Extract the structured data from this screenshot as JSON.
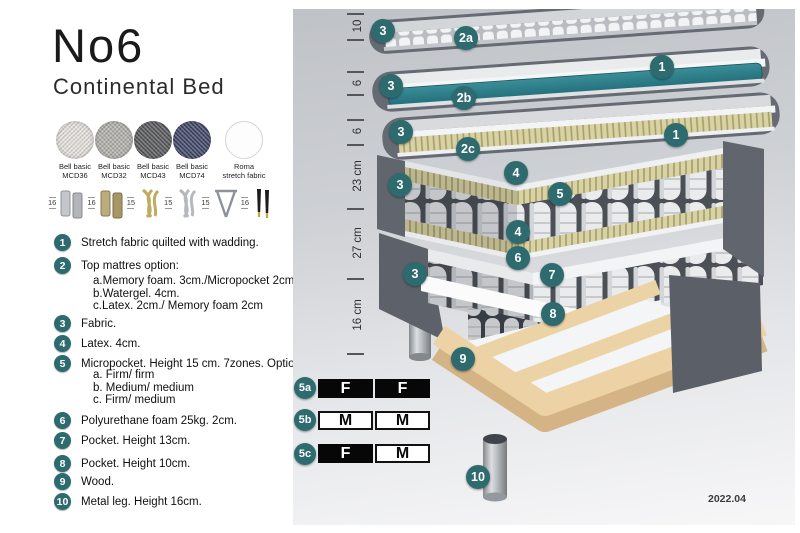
{
  "header": {
    "title": "No6",
    "subtitle": "Continental Bed"
  },
  "fabrics": [
    {
      "name": "Bell basic",
      "code": "MCD36",
      "color": "#e7e4df"
    },
    {
      "name": "Bell basic",
      "code": "MCD32",
      "color": "#b3b1ad"
    },
    {
      "name": "Bell basic",
      "code": "MCD43",
      "color": "#57585a"
    },
    {
      "name": "Bell basic",
      "code": "MCD74",
      "color": "#3e4565"
    },
    {
      "name": "Roma",
      "code": "stretch fabric",
      "color": "#fdfdfd"
    }
  ],
  "leg_options": [
    {
      "height": "16",
      "style": "cylinder-silver"
    },
    {
      "height": "16",
      "style": "cylinder-brass"
    },
    {
      "height": "15",
      "style": "twist-gold"
    },
    {
      "height": "15",
      "style": "twist-silver"
    },
    {
      "height": "15",
      "style": "hairpin-metal"
    },
    {
      "height": "16",
      "style": "taper-black-gold"
    }
  ],
  "legend": [
    {
      "num": "1",
      "text": "Stretch fabric quilted with wadding.",
      "subs": []
    },
    {
      "num": "2",
      "text": "Top mattres option:",
      "subs": [
        "a.Memory foam. 3cm./Micropocket 2cm",
        "b.Watergel. 4cm.",
        "c.Latex. 2cm./ Memory foam 2cm"
      ]
    },
    {
      "num": "3",
      "text": "Fabric.",
      "subs": []
    },
    {
      "num": "4",
      "text": "Latex. 4cm.",
      "subs": []
    },
    {
      "num": "5",
      "text": "Micropocket. Height 15 cm. 7zones. Option:",
      "subs": [
        "a. Firm/ firm",
        "b. Medium/ medium",
        "c. Firm/ medium"
      ]
    },
    {
      "num": "6",
      "text": "Polyurethane foam 25kg. 2cm.",
      "subs": []
    },
    {
      "num": "7",
      "text": "Pocket. Height 13cm.",
      "subs": []
    },
    {
      "num": "8",
      "text": "Pocket. Height 10cm.",
      "subs": []
    },
    {
      "num": "9",
      "text": "Wood.",
      "subs": []
    },
    {
      "num": "10",
      "text": "Metal leg. Height 16cm.",
      "subs": []
    }
  ],
  "diagram": {
    "ruler_labels": [
      "10",
      "6",
      "6",
      "23 cm",
      "27 cm",
      "16 cm"
    ],
    "badges": [
      "3",
      "2a",
      "1",
      "3",
      "2b",
      "3",
      "1",
      "2c",
      "3",
      "4",
      "5",
      "4",
      "6",
      "7",
      "3",
      "8",
      "9",
      "10"
    ],
    "firmness_options": [
      {
        "id": "5a",
        "cells": [
          {
            "label": "F",
            "filled": true
          },
          {
            "label": "F",
            "filled": true
          }
        ]
      },
      {
        "id": "5b",
        "cells": [
          {
            "label": "M",
            "filled": false
          },
          {
            "label": "M",
            "filled": false
          }
        ]
      },
      {
        "id": "5c",
        "cells": [
          {
            "label": "F",
            "filled": true
          },
          {
            "label": "M",
            "filled": false
          }
        ]
      }
    ],
    "version": "2022.04"
  },
  "colors": {
    "badge_teal": "#2d6b6f",
    "watergel_teal": "#2e7b86",
    "latex_tan": "#d9d2a2",
    "wood": "#e9cfa2",
    "fabric_gray": "#63686f"
  }
}
